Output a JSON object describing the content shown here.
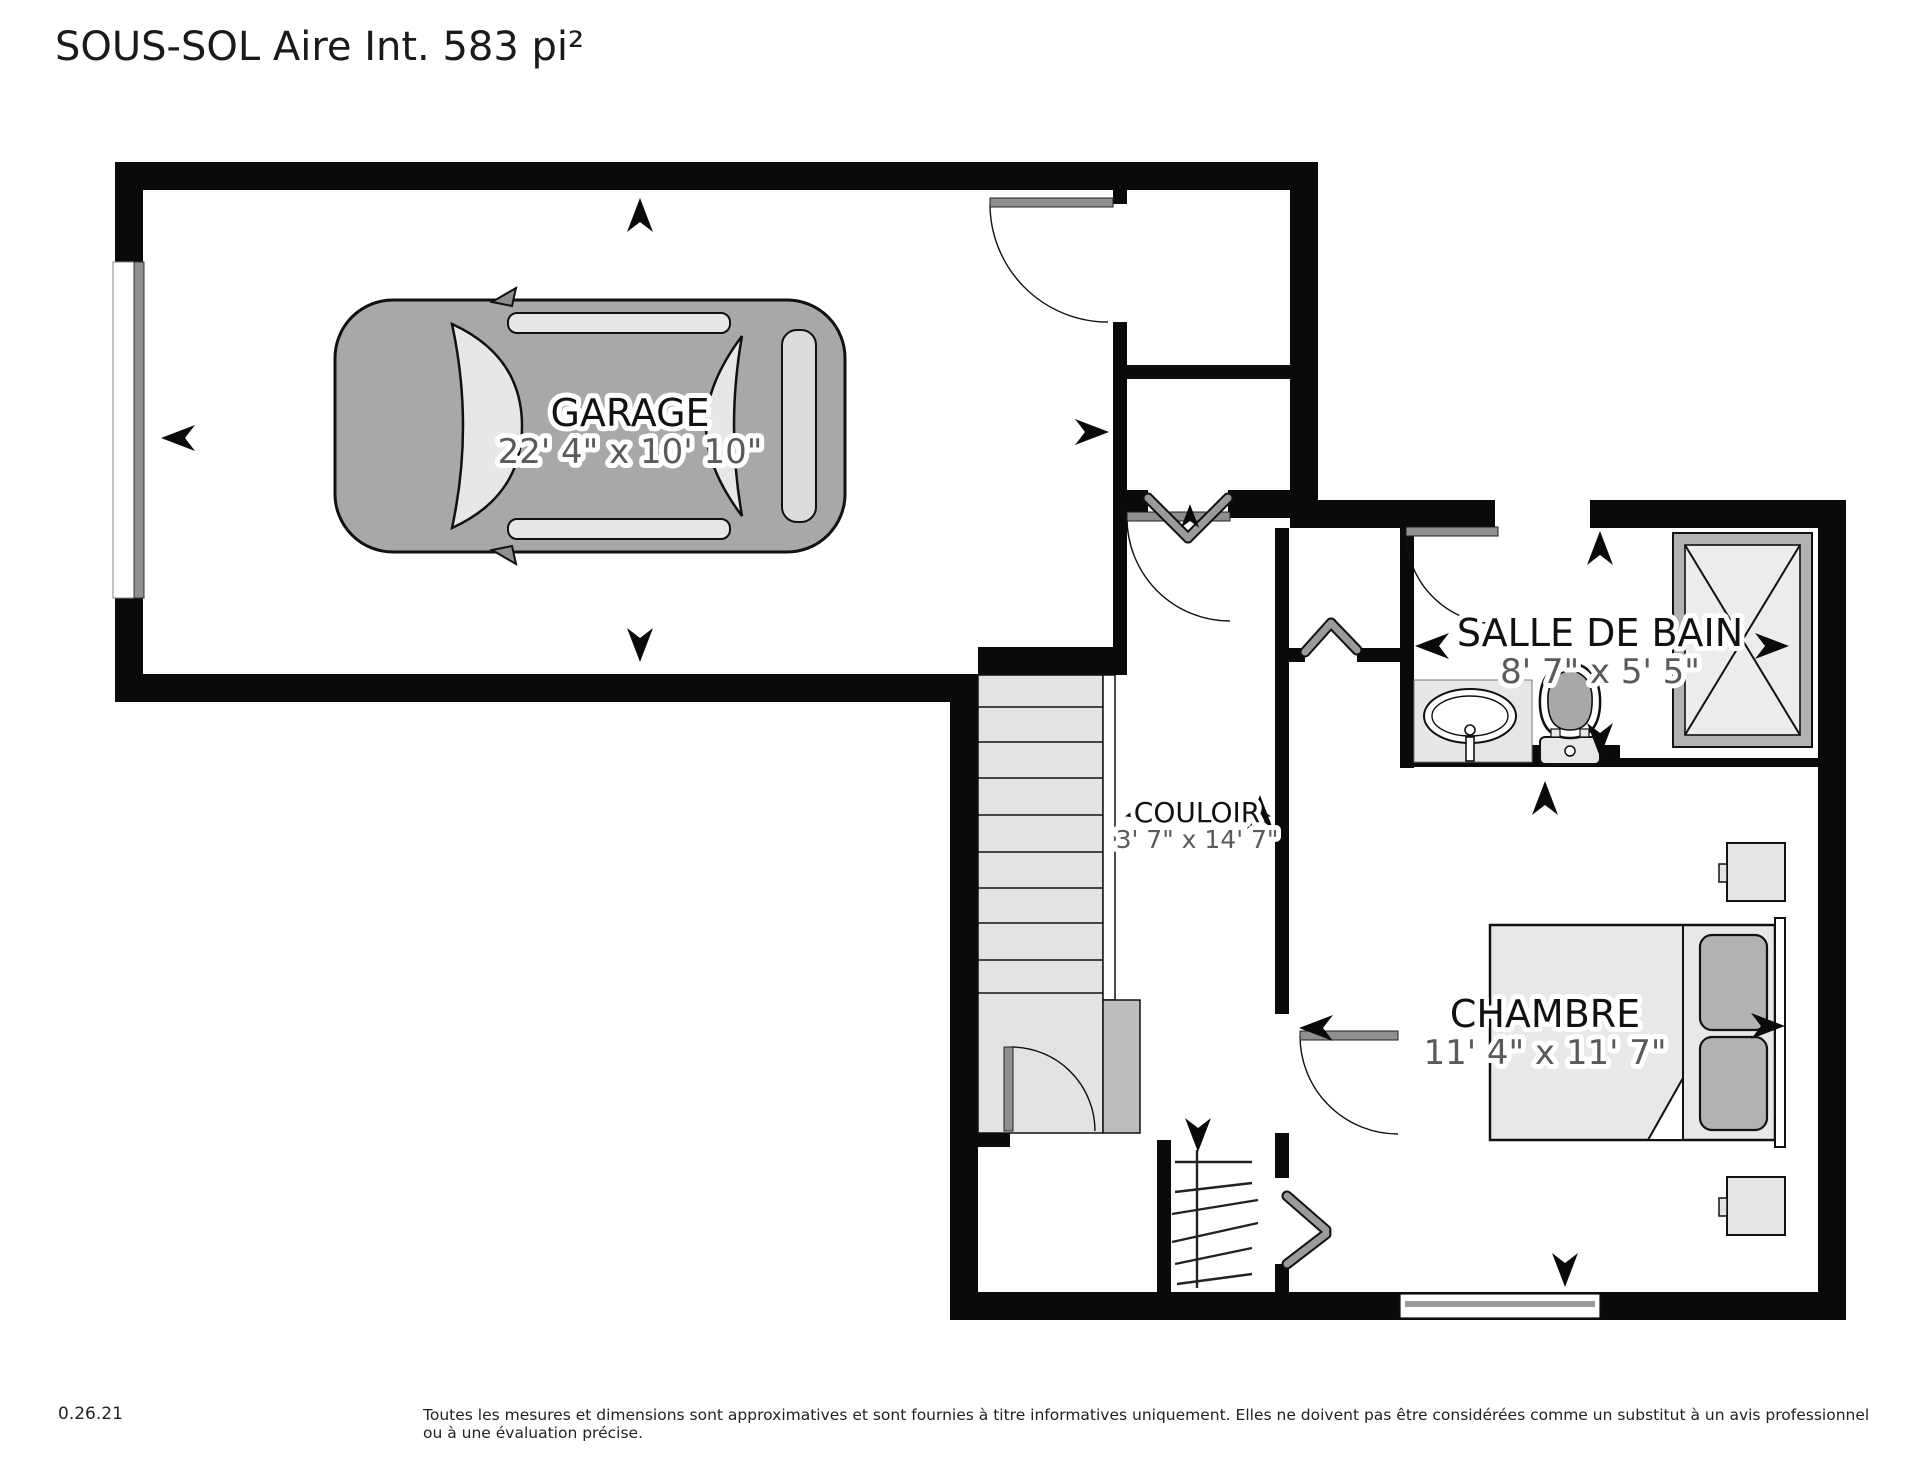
{
  "title": "SOUS-SOL Aire Int. 583 pi²",
  "rooms": {
    "garage": {
      "name": "GARAGE",
      "dims": "22' 4\" x 10' 10\""
    },
    "salle_de_bain": {
      "name": "SALLE DE BAIN",
      "dims": "8' 7\" x 5' 5\""
    },
    "couloir": {
      "name": "COULOIR",
      "dims": "3' 7\" x 14' 7\""
    },
    "chambre": {
      "name": "CHAMBRE",
      "dims": "11' 4\" x 11' 7\""
    }
  },
  "footer": {
    "version": "0.26.21",
    "disclaimer": "Toutes les mesures et dimensions sont approximatives et sont fournies à titre informatives uniquement. Elles ne doivent pas être considérées comme un substitut à un avis professionnel ou à une évaluation précise."
  },
  "colors": {
    "wall": "#0a0a0a",
    "floor_light": "#e3e3e3",
    "fixture_gray": "#a8a8a8",
    "dims_text": "#5a5a5a"
  }
}
